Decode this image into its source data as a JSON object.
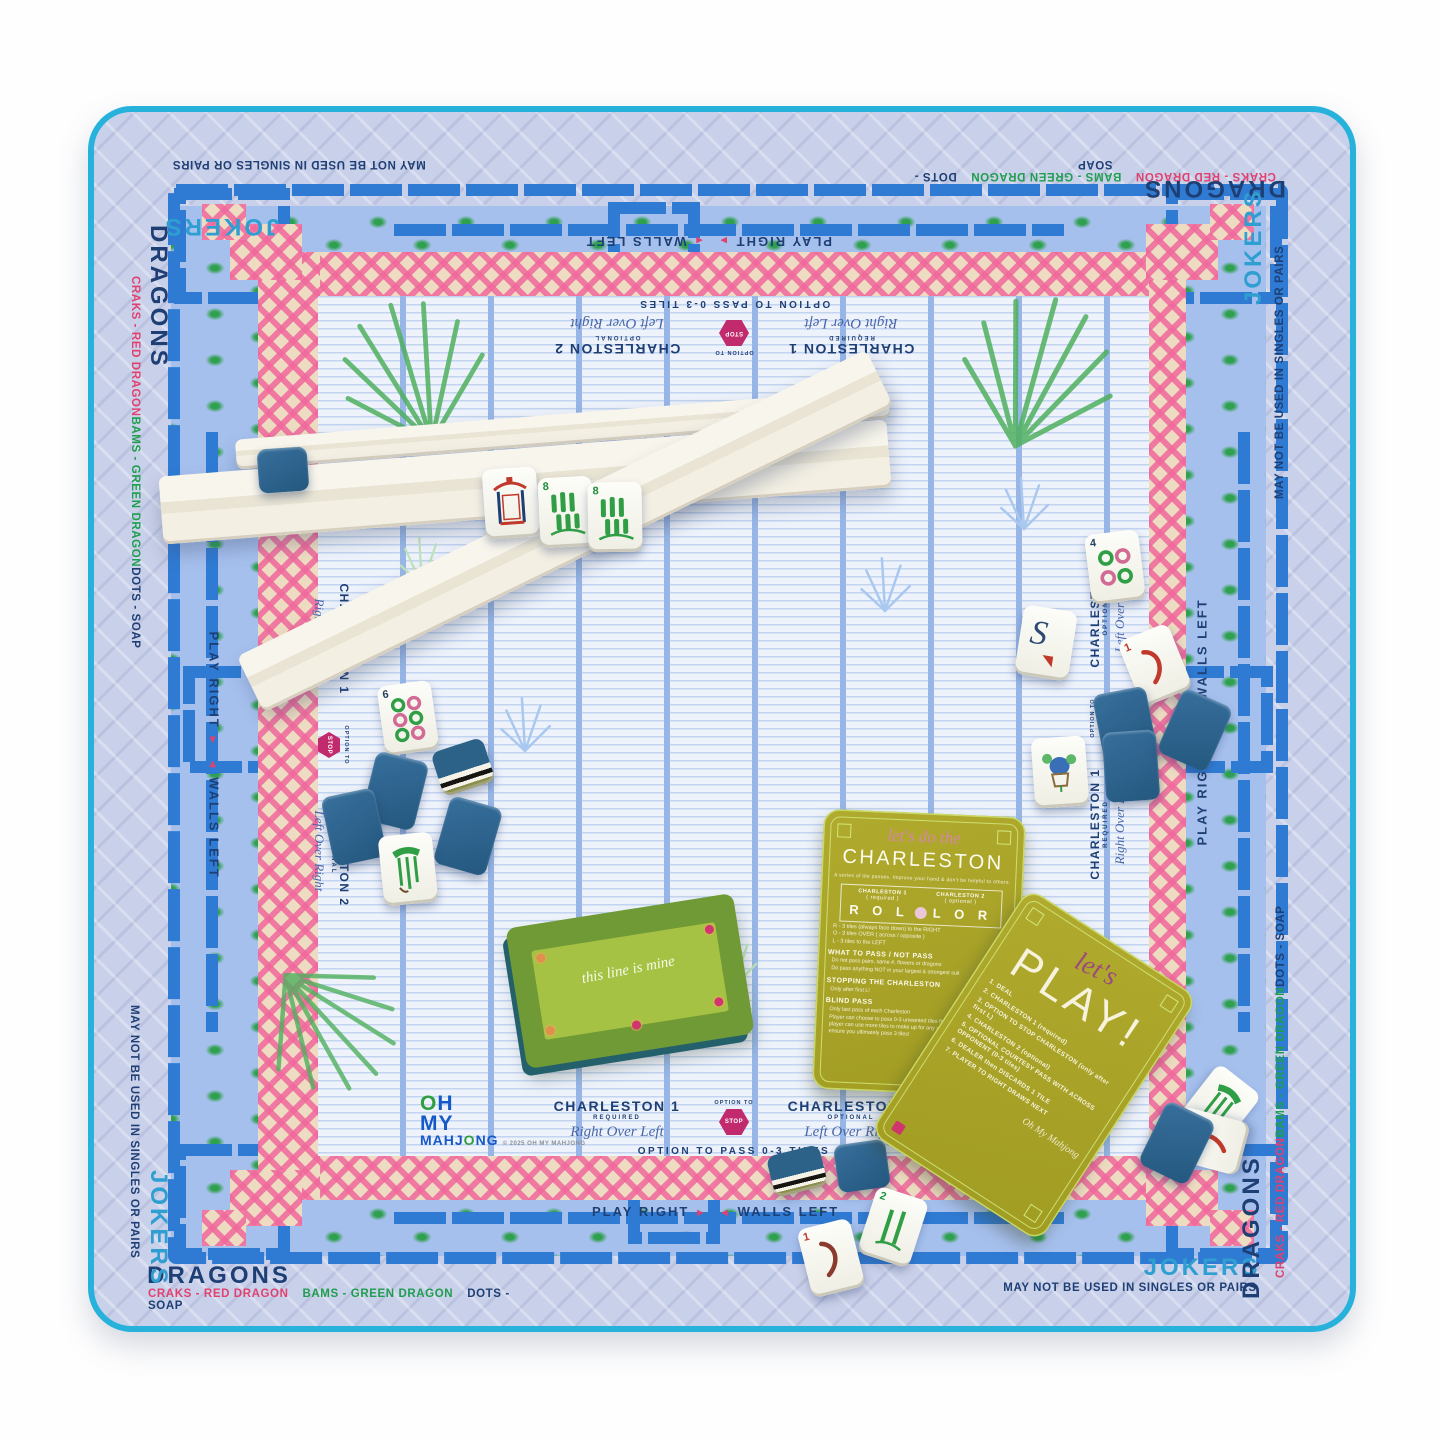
{
  "colors": {
    "turquoise": "#27b2dc",
    "cobalt": "#2f7bd4",
    "navy": "#1e3f74",
    "teal": "#2e9fd0",
    "pink": "#ee6f9e",
    "green": "#1f9e4f",
    "tile_back": "#2b5f88",
    "card_olive": "#a8a32b"
  },
  "mat": {
    "edge_words": {
      "jokers": "JOKERS",
      "dragons": "DRAGONS",
      "jokers_note": "MAY NOT BE USED IN SINGLES OR PAIRS",
      "craks_note": "CRAKS - RED DRAGON",
      "bams_note": "BAMS - GREEN DRAGON",
      "dots_note": "DOTS - SOAP"
    },
    "inner_labels": {
      "play_right": "PLAY RIGHT",
      "walls_left": "WALLS LEFT",
      "arrow_right": "►",
      "arrow_left": "◄",
      "charleston1_title": "CHARLESTON 1",
      "charleston1_sub": "REQUIRED",
      "charleston1_script": "Right Over Left",
      "charleston2_title": "CHARLESTON 2",
      "charleston2_sub": "OPTIONAL",
      "charleston2_script": "Left Over Right",
      "stop_pre": "OPTION TO",
      "stop_word": "STOP",
      "pass_note": "OPTION TO PASS 0-3 TILES"
    },
    "logo": {
      "o1": "O",
      "h": "H",
      "my": "MY",
      "m1": "MAHJ",
      "o2": "O",
      "ng": "NG",
      "copyright": "© 2025 OH MY MAHJONG"
    }
  },
  "cards": {
    "charleston": {
      "script": "let's do the",
      "title": "CHARLESTON",
      "subtitle": "A series of tile passes. Improve your hand & don't be helpful to others.",
      "col1": "CHARLESTON 1",
      "col1_sub": "( required )",
      "col2": "CHARLESTON 2",
      "col2_sub": "( optional )",
      "letters1": "R O L",
      "letters2": "L O R",
      "legend": [
        "R - 3 tiles (always face down) to the RIGHT",
        "O - 3 tiles OVER ( across / opposite )",
        "L - 3 tiles to the LEFT"
      ],
      "pass_head": "WHAT TO PASS / NOT PASS",
      "pass_items": [
        "Do not pass pairs, same #, flowers or dragons",
        "Do pass anything NOT in your largest & strongest suit"
      ],
      "stop_head": "STOPPING THE CHARLESTON",
      "stop_item": "Only after first L!",
      "blind_head": "BLIND PASS",
      "blind_items": [
        "Only last pass of each Charleston",
        "Player can choose to pass 0-3 unwanted tiles from their hand. Then, player can use more tiles to make up for any shortcomings. Just ensure you ultimately pass 3 tiles!"
      ]
    },
    "play": {
      "script": "let's",
      "title": "PLAY!",
      "steps": [
        "1. DEAL",
        "2. CHARLESTON 1 (required)",
        "3. OPTION TO STOP CHARLESTON (only after first L)",
        "4. CHARLESTON 2 (optional)",
        "5. OPTIONAL COURTESY PASS WITH ACROSS OPPONENT (0-3 tiles)",
        "6. DEALER then DISCARDS 1 TILE",
        "7. PLAYER TO RIGHT DRAWS NEXT"
      ],
      "signoff": "Oh My Mahjong"
    },
    "line": {
      "script": "this line is mine"
    }
  },
  "tile_nums": {
    "n8": "8",
    "n6": "6",
    "n4": "4",
    "nS": "S",
    "n1": "1",
    "n2": "2"
  }
}
